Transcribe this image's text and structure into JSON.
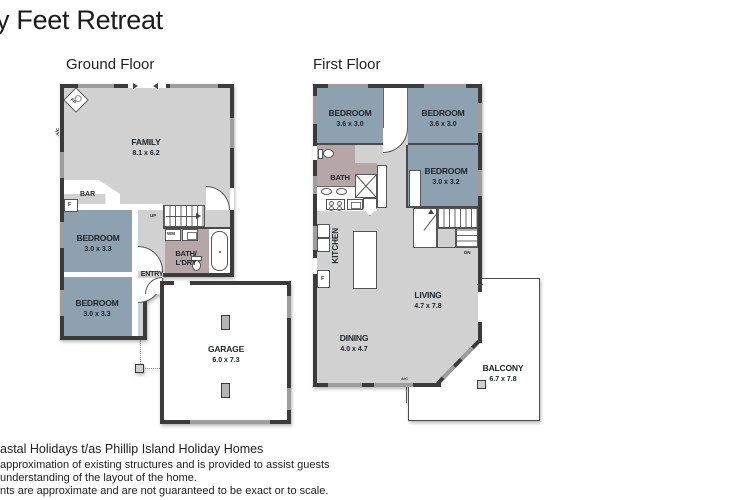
{
  "title": "y Feet Retreat",
  "colors": {
    "bedroom_fill": "#8da1b0",
    "bath_fill": "#b7a6a8",
    "floor_fill": "#d1d1d1",
    "wall": "#3b3b3b",
    "window": "#9d9d9d"
  },
  "ground_floor": {
    "label": "Ground Floor",
    "family": {
      "name": "FAMILY",
      "dims": "8.1 x 6.2"
    },
    "bedroom1": {
      "name": "BEDROOM",
      "dims": "3.0 x 3.3"
    },
    "bedroom2": {
      "name": "BEDROOM",
      "dims": "3.0 x 3.3"
    },
    "bath": {
      "line1": "BATH/",
      "line2": "L'DRY"
    },
    "garage": {
      "name": "GARAGE",
      "dims": "6.0 x 7.3"
    },
    "bar": "BAR",
    "entry": "ENTRY",
    "up": "UP",
    "wm": "WM",
    "fireplace": "FP",
    "ac": "A/C",
    "fridge": "F"
  },
  "first_floor": {
    "label": "First Floor",
    "bedroom_top_left": {
      "name": "BEDROOM",
      "dims": "3.6 x 3.0"
    },
    "bedroom_top_right": {
      "name": "BEDROOM",
      "dims": "3.6 x 3.0"
    },
    "bedroom_right": {
      "name": "BEDROOM",
      "dims": "3.0 x 3.2"
    },
    "bath": "BATH",
    "kitchen": "KITCHEN",
    "living": {
      "name": "LIVING",
      "dims": "4.7 x 7.8"
    },
    "dining": {
      "name": "DINING",
      "dims": "4.0 x 4.7"
    },
    "balcony": {
      "name": "BALCONY",
      "dims": "6.7 x 7.8"
    },
    "down": "DN",
    "fridge": "F",
    "ac": "A/C"
  },
  "footer": {
    "line1": "astal Holidays t/as Phillip Island Holiday Homes",
    "line2": "approximation of existing structures and is provided to assist guests",
    "line3": "understanding of the layout of the home.",
    "line4": "nts are approximate and are not guaranteed to be exact or to scale."
  }
}
